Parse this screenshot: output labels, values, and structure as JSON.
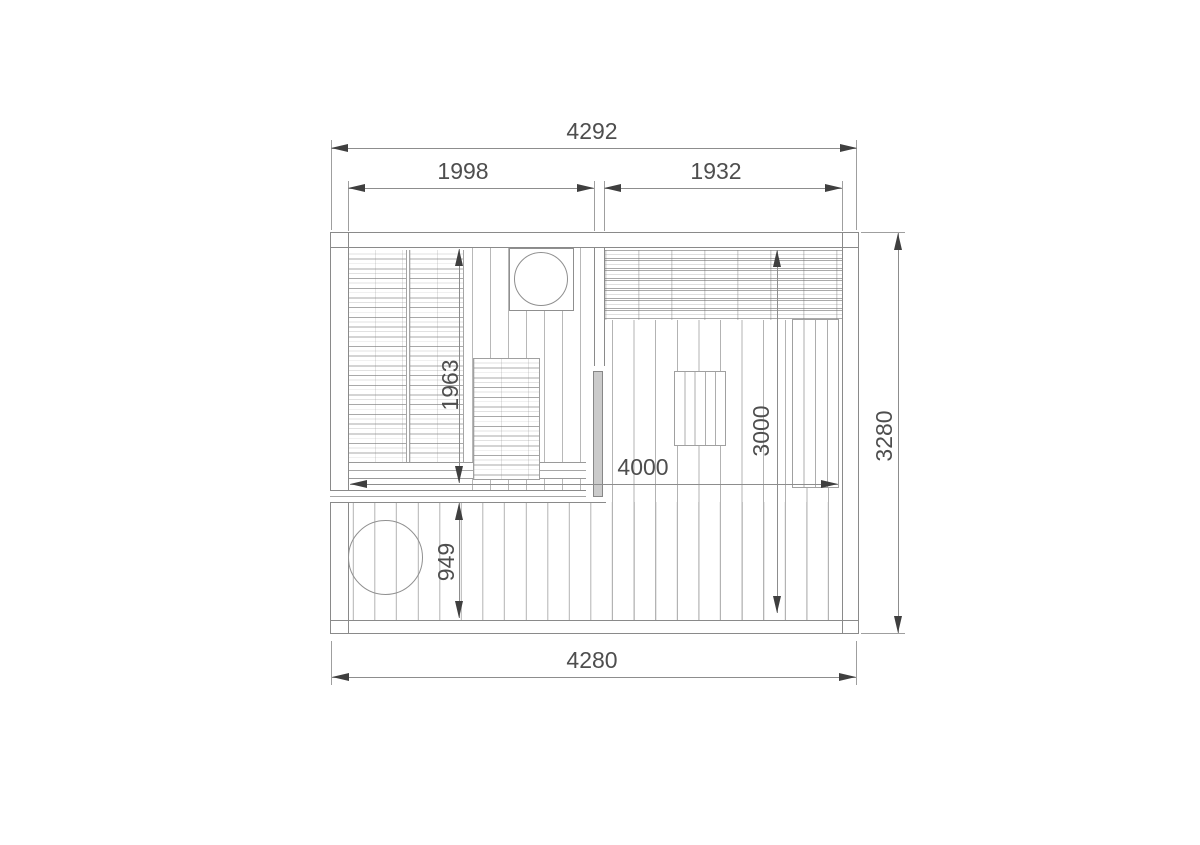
{
  "drawing": {
    "type": "floor-plan",
    "dims": {
      "top_overall": "4292",
      "top_left_room": "1998",
      "top_right_room": "1932",
      "left_room_depth": "1963",
      "front_deck_depth": "949",
      "inner_width": "4000",
      "right_room_depth": "3000",
      "side_overall": "3280",
      "bottom_overall": "4280"
    },
    "colors": {
      "wall_line": "#8a8a8a",
      "board_line": "#b3b3b3",
      "dimension_line": "#8d8d8d",
      "arrow": "#3f3f3f",
      "text": "#4e4e4e",
      "door_fill": "#cbcbcb",
      "background": "#ffffff"
    }
  }
}
